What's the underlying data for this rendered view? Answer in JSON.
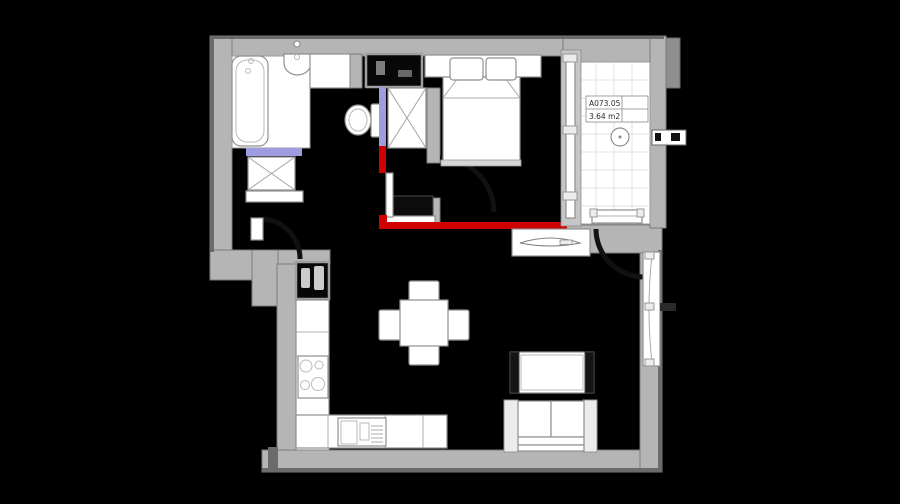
{
  "balcony_label": {
    "code": "A073.05",
    "area": "3.64 m2"
  },
  "colors": {
    "bg": "#000000",
    "wall": "#b5b5b5",
    "wall_dark": "#8f8f8f",
    "highlight_red": "#d10000",
    "highlight_blue": "#9d9de0",
    "floor_tile_line": "#e2e2e2"
  }
}
